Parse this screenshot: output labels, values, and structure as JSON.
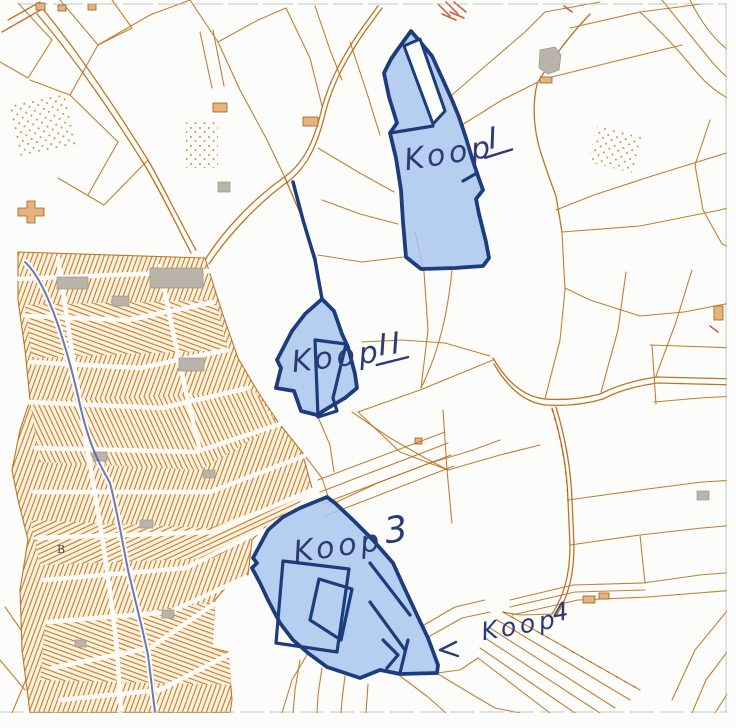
{
  "map": {
    "description": "Scanned cadastral auction map with four hand-marked sale lots",
    "labels": {
      "place_b": "B"
    },
    "parcels": [
      {
        "id": "koop-1",
        "word": "Koop",
        "numeral": "I",
        "underlined": true,
        "fill": "#a9c5ec"
      },
      {
        "id": "koop-2",
        "word": "Koop",
        "numeral": "II",
        "underlined": true,
        "fill": "#a9c5ec"
      },
      {
        "id": "koop-3",
        "word": "Koop",
        "numeral": "3",
        "underlined": false,
        "fill": "#a9c5ec"
      },
      {
        "id": "koop-4",
        "word": "Koop",
        "numeral": "4",
        "underlined": false,
        "arrow": "points-left"
      }
    ],
    "colors": {
      "parcel_line": "#bd7524",
      "parcel_line_dark": "#96621f",
      "urban_fill": "#faf1de",
      "urban_hatch": "#c47c2b",
      "building_gray": "#b9b3a9",
      "highlight_fill": "#a9c5ec",
      "highlight_border": "#1c3c7c",
      "ink": "#2c3a76",
      "water": "#5560a5",
      "survey_red": "#cc3a10",
      "frame": "#aeb8bc"
    }
  }
}
